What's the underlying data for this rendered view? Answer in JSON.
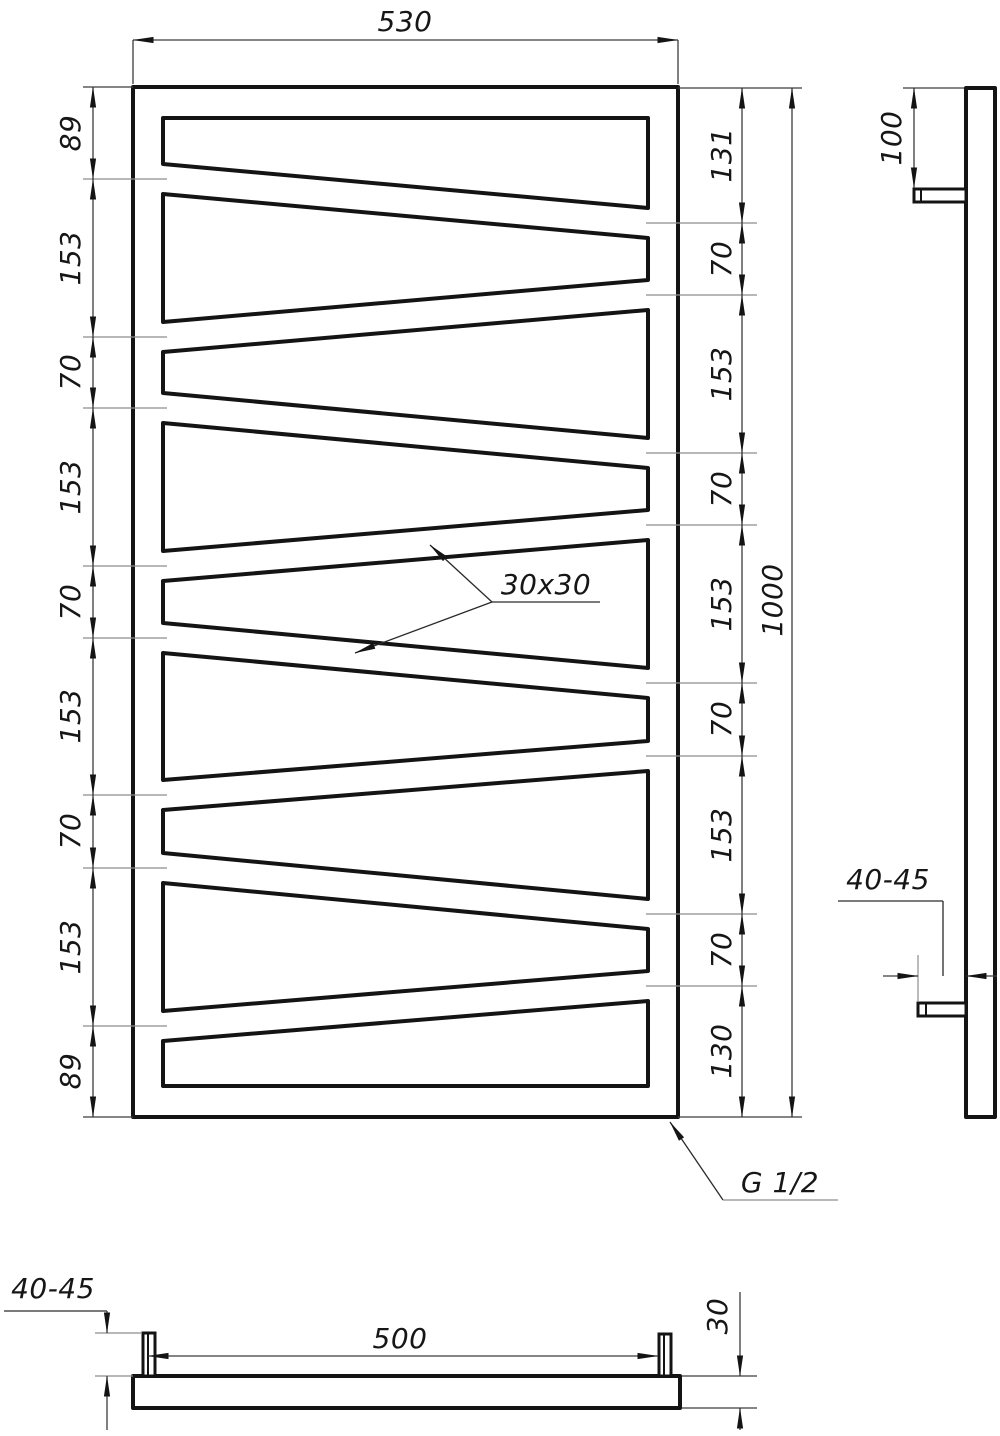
{
  "colors": {
    "line": "#141414",
    "background": "#ffffff",
    "dimension_line": "#3c3c3c"
  },
  "front_view": {
    "overall_width": "530",
    "overall_height": "1000",
    "left_dimensions": [
      "89",
      "153",
      "70",
      "153",
      "70",
      "153",
      "70",
      "153",
      "89"
    ],
    "right_dimensions": [
      "131",
      "70",
      "153",
      "70",
      "153",
      "70",
      "153",
      "70",
      "130"
    ],
    "tube_section_label": "30x30",
    "thread_label": "G 1/2"
  },
  "side_view": {
    "top_bracket_offset": "100",
    "wall_distance": "40-45"
  },
  "bottom_view": {
    "bracket_span": "500",
    "tube_depth": "30",
    "wall_distance": "40-45"
  }
}
